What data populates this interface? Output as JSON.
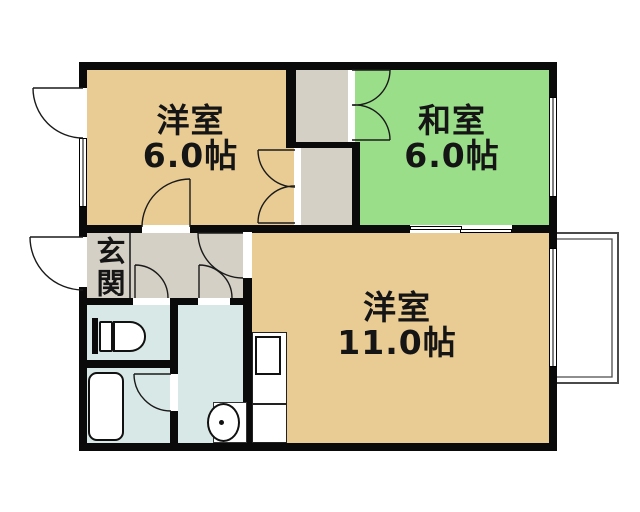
{
  "rooms": {
    "western1": {
      "name": "洋室",
      "size": "6.0帖"
    },
    "japanese": {
      "name": "和室",
      "size": "6.0帖"
    },
    "western2": {
      "name": "洋室",
      "size": "11.0帖"
    },
    "entrance": {
      "name": "玄関"
    }
  },
  "colors": {
    "western_room": "#e9cb94",
    "japanese_room": "#9ade8a",
    "hall_gray": "#d5d0c5",
    "wet_blue": "#d8e8e6",
    "wall_black": "#0a0a0a",
    "line_dark": "#1a1a1a",
    "balcony_gray": "#4a4a4a",
    "background": "#ffffff"
  },
  "fixture_icons": [
    "toilet-icon",
    "bathtub-icon",
    "washing-machine-icon",
    "kitchen-unit-icon",
    "balcony",
    "door-swing-arc",
    "double-closet-doors",
    "sliding-door",
    "window"
  ]
}
